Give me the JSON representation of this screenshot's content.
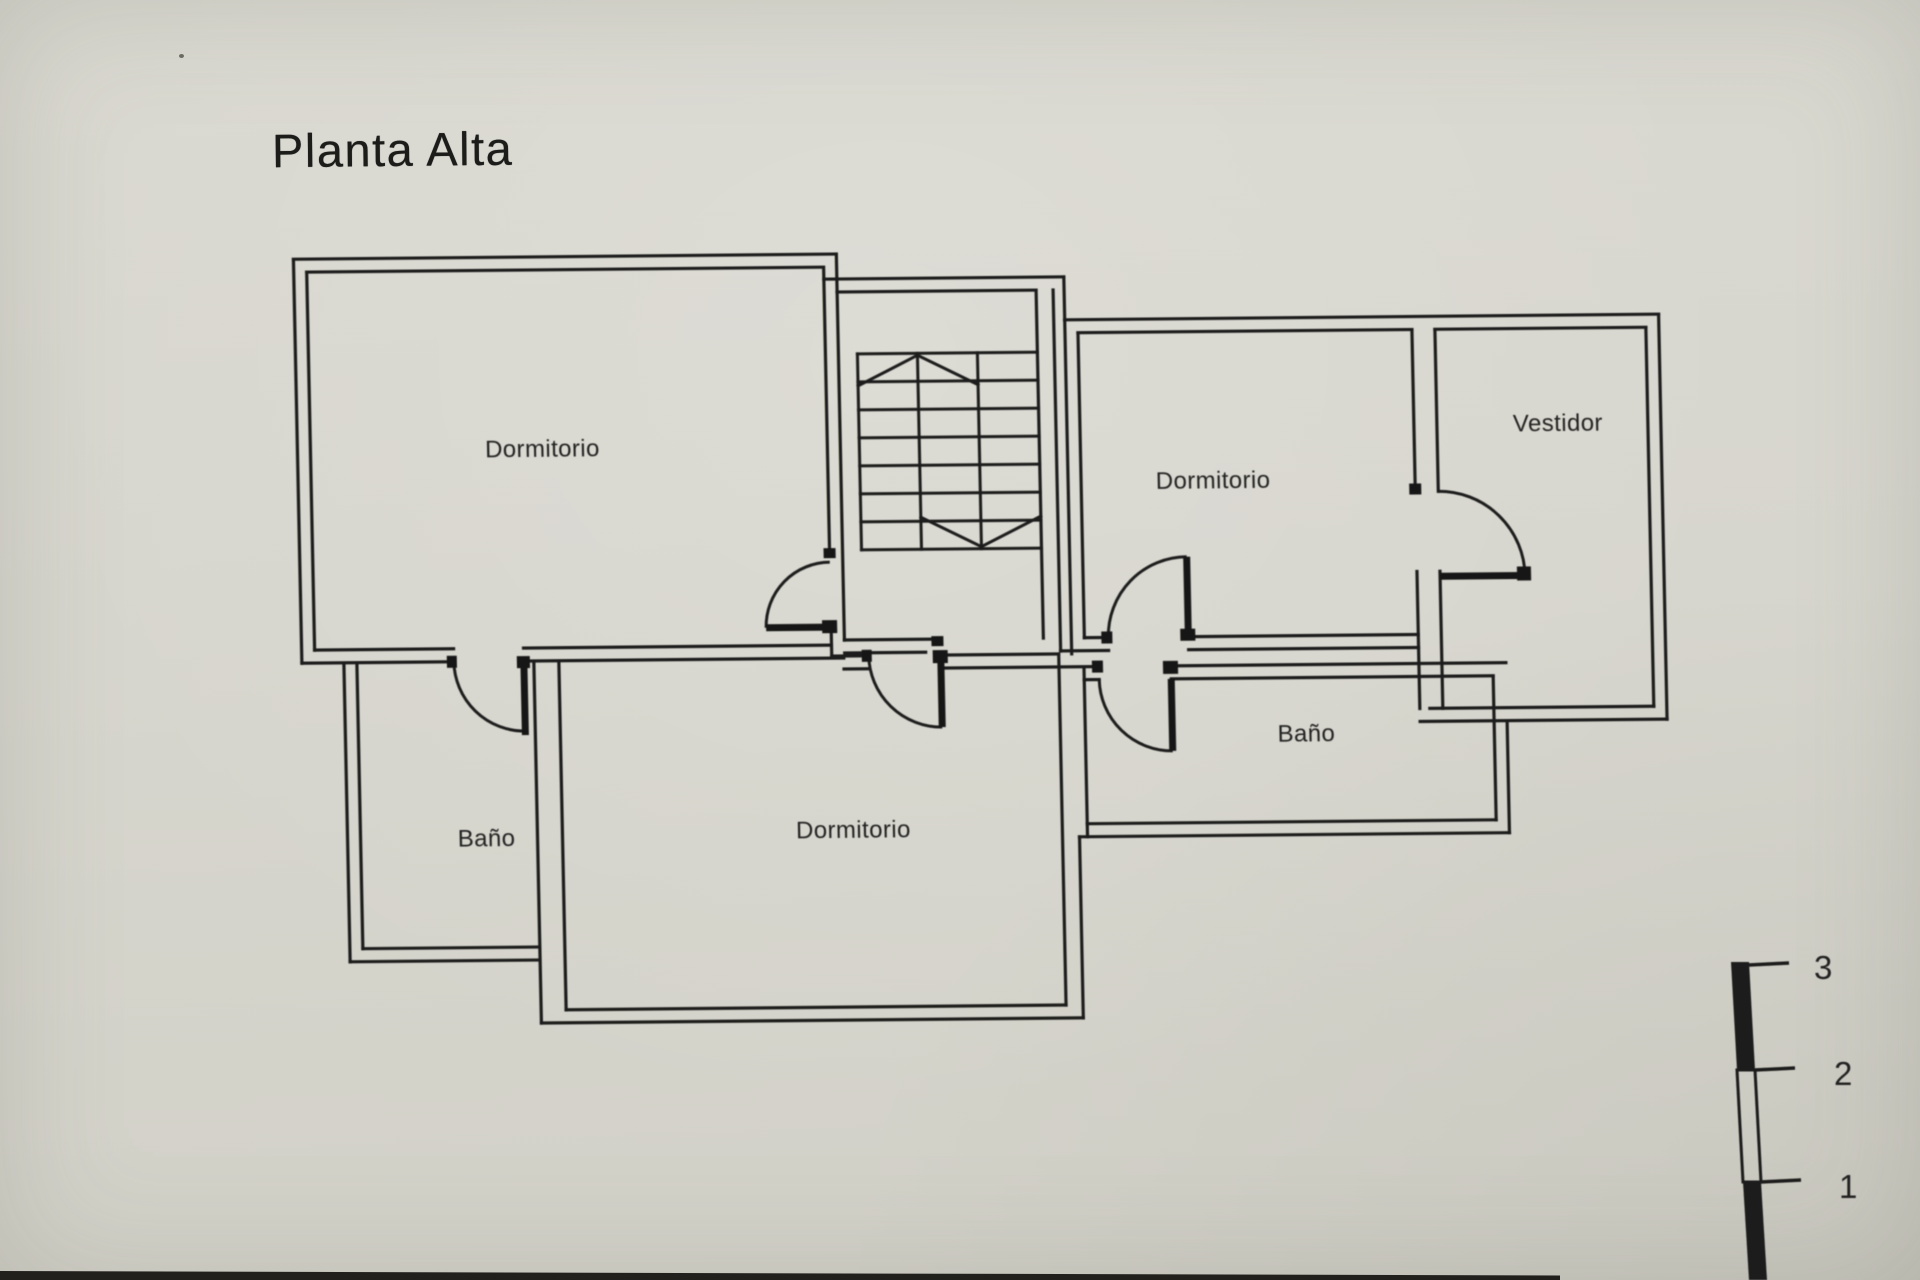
{
  "document": {
    "title": "Planta Alta"
  },
  "floorplan": {
    "rooms": [
      {
        "name": "dormitorio-top-left",
        "label": "Dormitorio"
      },
      {
        "name": "dormitorio-right",
        "label": "Dormitorio"
      },
      {
        "name": "vestidor",
        "label": "Vestidor"
      },
      {
        "name": "bano-right",
        "label": "Baño"
      },
      {
        "name": "dormitorio-bottom",
        "label": "Dormitorio"
      },
      {
        "name": "bano-left",
        "label": "Baño"
      }
    ],
    "scale_bar": {
      "tick_labels": [
        "3",
        "2",
        "1"
      ]
    }
  },
  "colors": {
    "paper": "#d7d6ce",
    "ink": "#1f1f1e"
  }
}
